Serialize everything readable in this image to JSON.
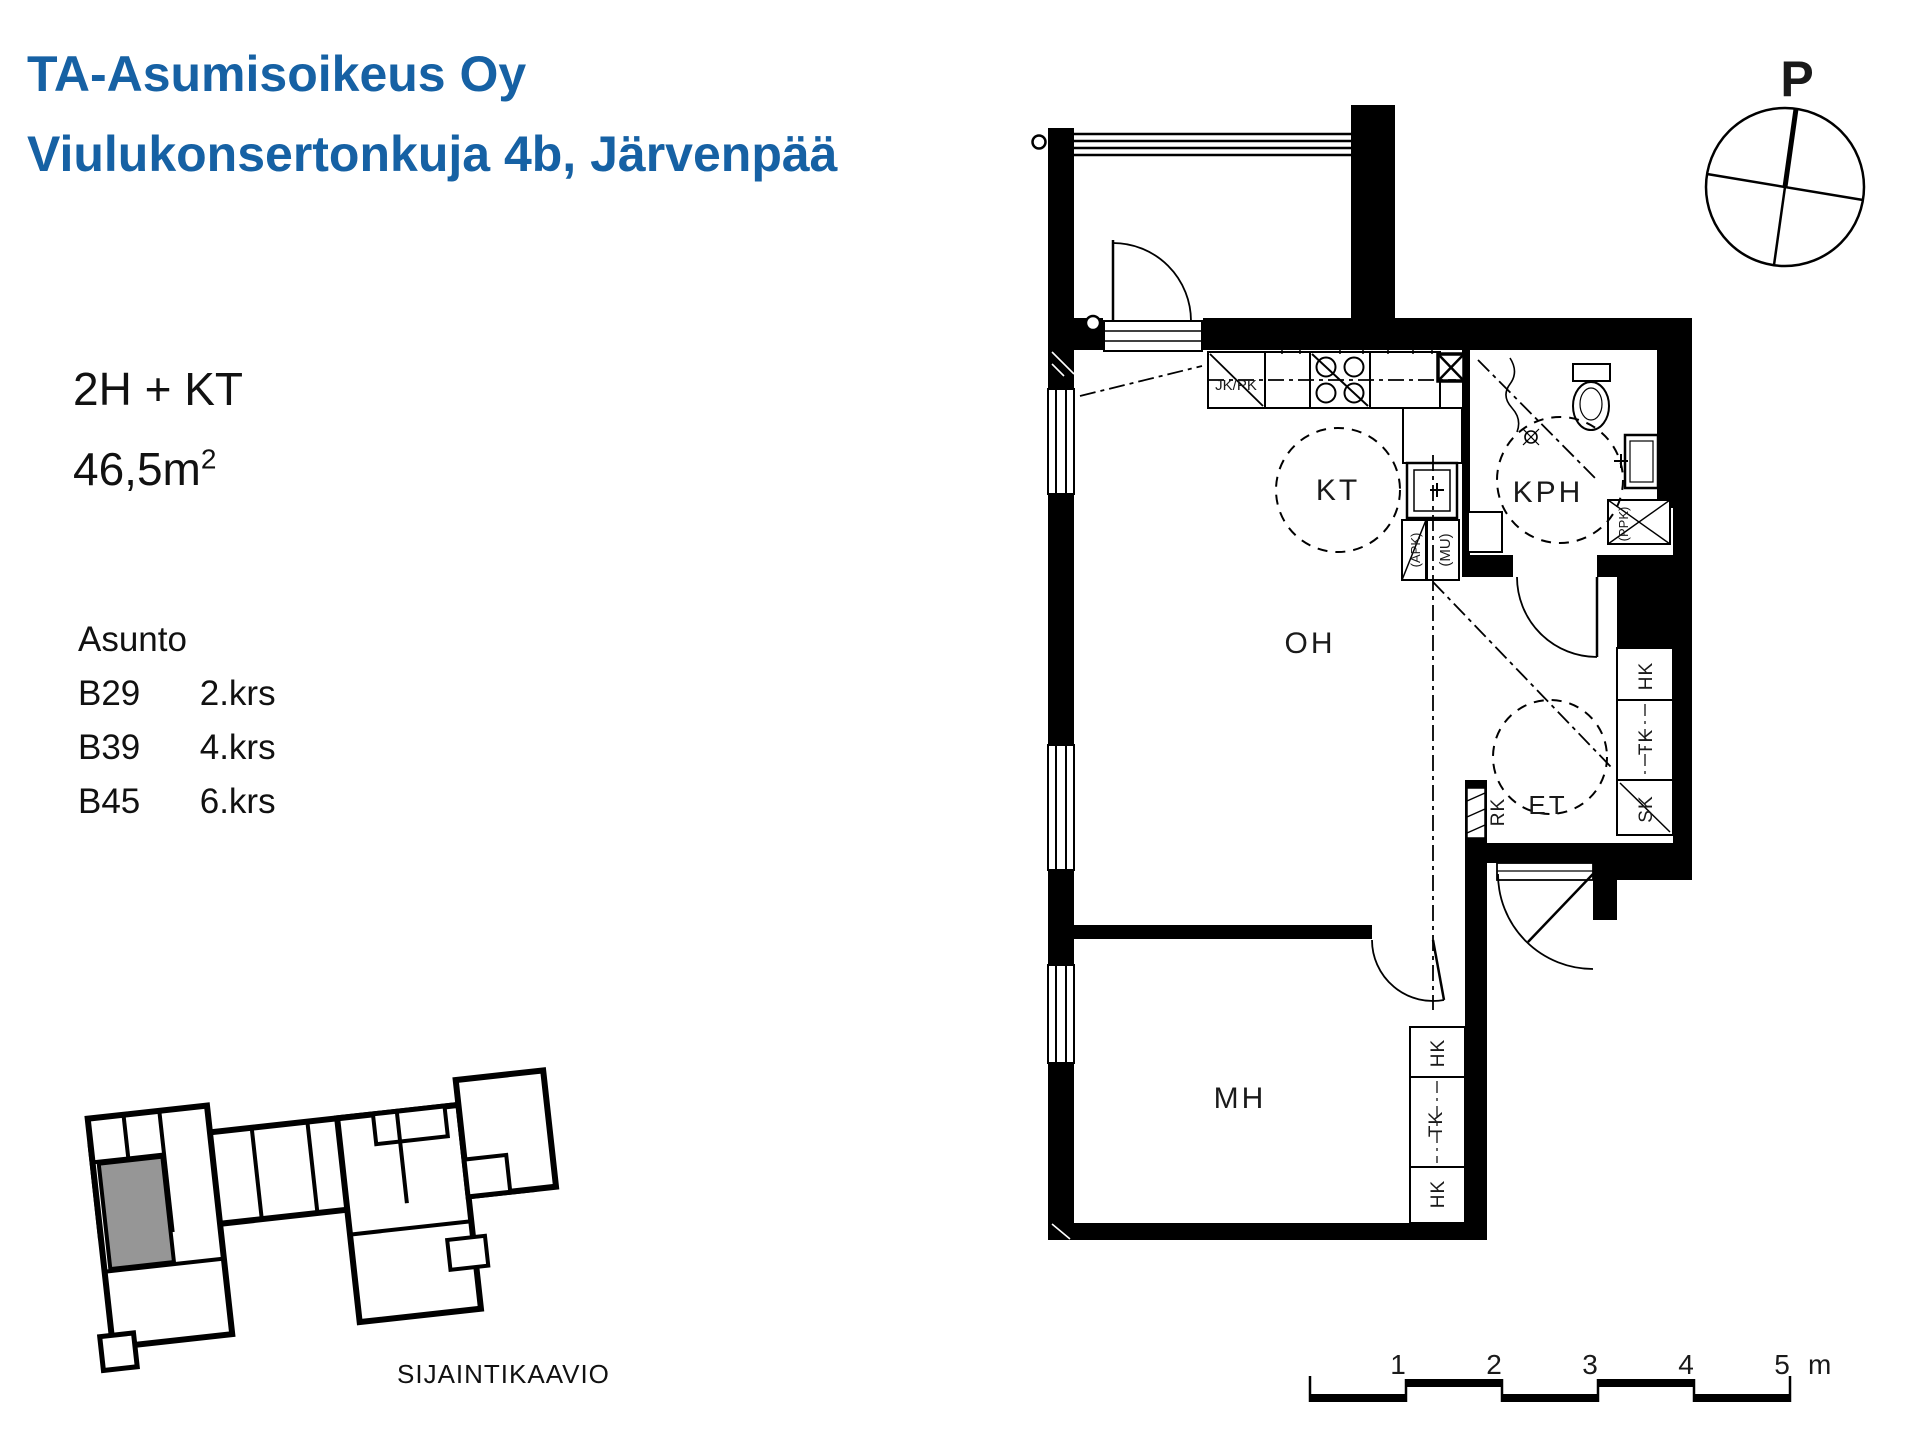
{
  "header": {
    "company": "TA-Asumisoikeus Oy",
    "address": "Viulukonsertonkuja 4b, Järvenpää"
  },
  "apartment": {
    "type": "2H + KT",
    "area_base": "46,5m",
    "area_sup": "2",
    "list_label": "Asunto",
    "units": [
      {
        "id": "B29",
        "floor": "2.krs"
      },
      {
        "id": "B39",
        "floor": "4.krs"
      },
      {
        "id": "B45",
        "floor": "6.krs"
      }
    ]
  },
  "plan": {
    "rooms": [
      {
        "label": "KT"
      },
      {
        "label": "KPH"
      },
      {
        "label": "OH"
      },
      {
        "label": "ET"
      },
      {
        "label": "MH"
      }
    ],
    "appliances": {
      "fridge": "JK/PK",
      "dishwasher": "(APK)",
      "microwave": "(MU)",
      "washer": "(PPK)",
      "electrical": "RK"
    },
    "entry_closets": [
      {
        "label": "HK"
      },
      {
        "label": "TK"
      },
      {
        "label": "SK"
      }
    ],
    "bedroom_closets": [
      {
        "label": "HK"
      },
      {
        "label": "TK"
      },
      {
        "label": "HK"
      }
    ]
  },
  "compass": {
    "label": "P"
  },
  "scale_bar": {
    "ticks": [
      {
        "label": "1"
      },
      {
        "label": "2"
      },
      {
        "label": "3"
      },
      {
        "label": "4"
      },
      {
        "label": "5"
      }
    ],
    "unit": "m"
  },
  "location": {
    "caption": "SIJAINTIKAAVIO"
  },
  "colors": {
    "accent": "#1661A4",
    "highlight": "#969696"
  }
}
